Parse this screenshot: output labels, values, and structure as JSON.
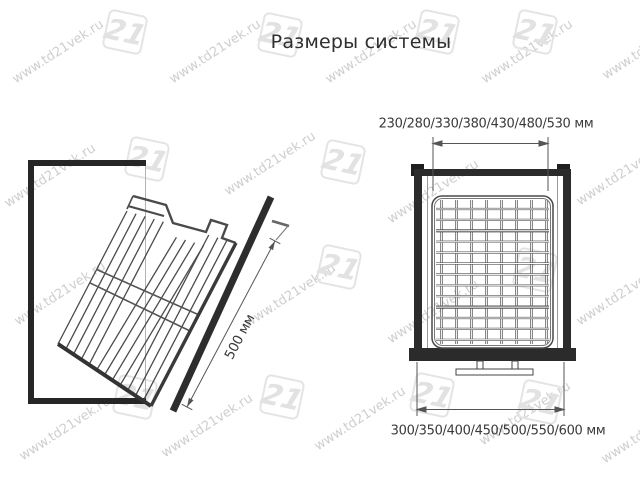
{
  "title": "Размеры системы",
  "watermark": {
    "text": "www.td21vek.ru",
    "logo_text": "21",
    "color": "#c9c9c9"
  },
  "left_diagram": {
    "name": "боковой вид — выдвижная корзина",
    "dimension_label": "500 мм"
  },
  "right_diagram": {
    "name": "фронтальный вид — корзина в каркасе",
    "top_dimension_label": "230/280/330/380/430/480/530 мм",
    "bottom_dimension_label": "300/350/400/450/500/550/600 мм"
  },
  "colors": {
    "frame": "#2b2b2b",
    "wire": "#555555",
    "dimension_line": "#555555",
    "text": "#3a3a3a",
    "background": "#ffffff"
  }
}
